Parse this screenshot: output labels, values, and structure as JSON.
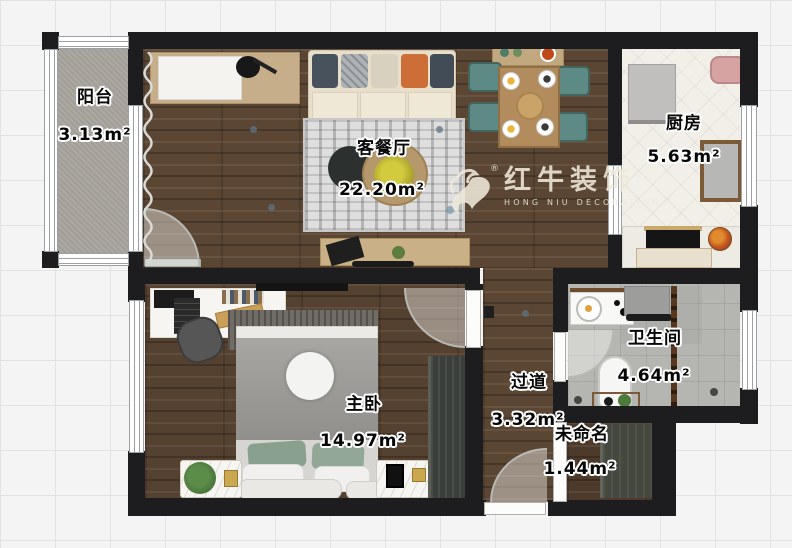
{
  "plan": {
    "watermark": {
      "brand": "红牛装饰",
      "brand_en": "HONG NIU DECORATION",
      "registered": "®"
    },
    "rooms": [
      {
        "id": "balcony",
        "name": "阳台",
        "area": "3.13m²"
      },
      {
        "id": "living-dining",
        "name": "客餐厅",
        "area": "22.20m²"
      },
      {
        "id": "kitchen",
        "name": "厨房",
        "area": "5.63m²"
      },
      {
        "id": "master-bedroom",
        "name": "主卧",
        "area": "14.97m²"
      },
      {
        "id": "hallway",
        "name": "过道",
        "area": "3.32m²"
      },
      {
        "id": "bathroom",
        "name": "卫生间",
        "area": "4.64m²"
      },
      {
        "id": "unnamed",
        "name": "未命名",
        "area": "1.44m²"
      }
    ],
    "colors": {
      "wall": "#1d1d1f",
      "wood_floor": "#5b4634",
      "balcony_floor": "#a8a39d",
      "kitchen_floor": "#f1efe7",
      "bathroom_floor": "#b5b5b1",
      "accent_teal": "#5d8a84",
      "accent_orange": "#cd6d38",
      "watermark_color": "#eee9da"
    }
  }
}
